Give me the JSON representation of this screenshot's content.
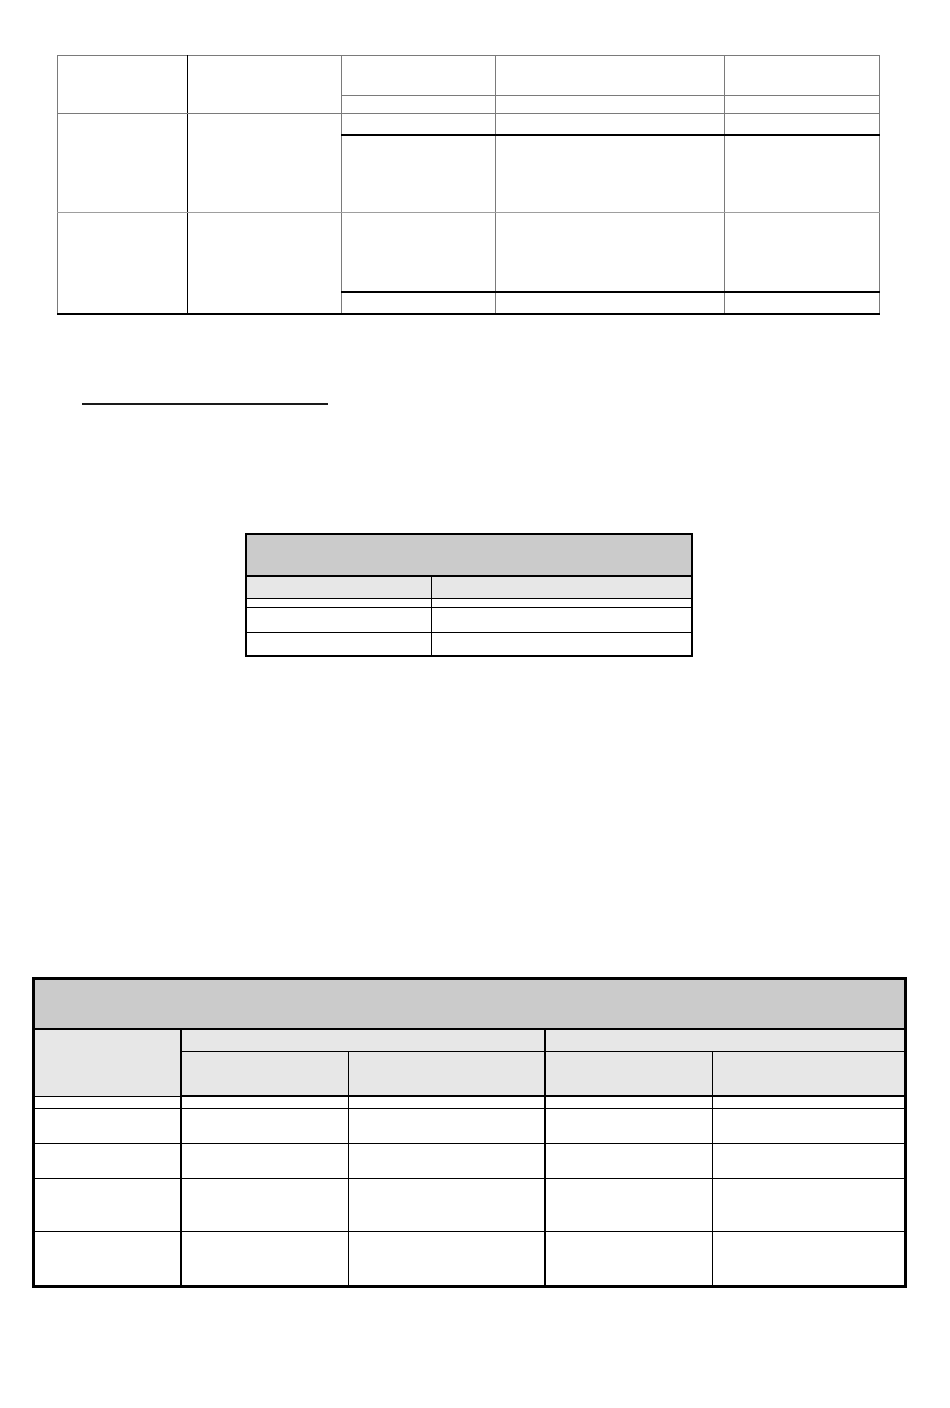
{
  "page": {
    "width_px": 950,
    "height_px": 1408,
    "background": "#ffffff",
    "visible_text": "",
    "description_of_rendered_content": "blank document page with three empty tables and one short horizontal rule; no text is rendered anywhere"
  },
  "colors": {
    "border_gray": "#7a7a7a",
    "border_light_gray": "#9e9e9e",
    "border_black": "#000000",
    "header_fill_dark": "#cbcbcb",
    "header_fill_light": "#e7e7e7",
    "rule_black": "#1a1a1a",
    "page_bg": "#ffffff"
  },
  "top_table": {
    "all_cells_empty": true,
    "column_count": 5,
    "column_widths_px": [
      130,
      154,
      154,
      229,
      155
    ],
    "left_section_row_heights_px": [
      57,
      98,
      100
    ],
    "right_section_row_heights_px": [
      39,
      18,
      21,
      77,
      78,
      22
    ]
  },
  "heading_rule": {
    "text_above": "",
    "width_px": 246,
    "thickness_px": 2
  },
  "middle_table": {
    "all_cells_empty": true,
    "title_row_text": "",
    "column_count": 2,
    "column_widths_px": [
      185,
      261
    ],
    "row_heights_px": [
      42,
      22,
      9,
      25,
      24
    ]
  },
  "bottom_table": {
    "all_cells_empty": true,
    "title_row_text": "",
    "column_count": 5,
    "column_widths_px": [
      147,
      168,
      196,
      168,
      193
    ],
    "header_group_count": 2,
    "row_heights_px": [
      50,
      22,
      44,
      12,
      35,
      35,
      53,
      55
    ]
  }
}
